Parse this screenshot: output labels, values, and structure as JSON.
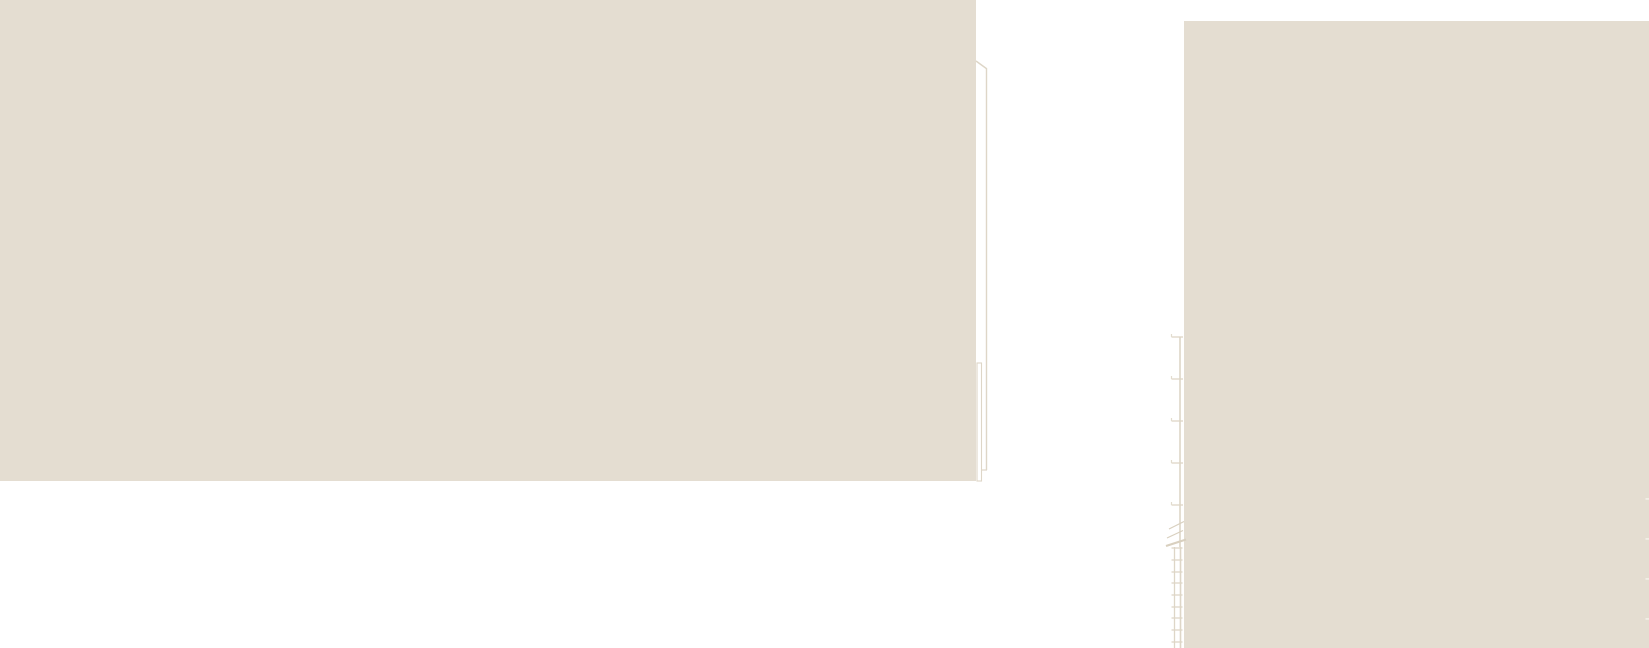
{
  "canvas": {
    "width": 1649,
    "height": 648,
    "background": "#ffffff",
    "description": "Fragment of an architectural elevation drawing: two flat wall panels, an eave edge line, a downpipe outline, and a dimension line with break symbol and ladder/scale detail"
  },
  "colors": {
    "panel_fill": "#e4ddd1",
    "hairline": "#ded6c7",
    "hairline_soft": "#e3dccf",
    "break_line": "#d9d0bf",
    "white_tick": "#f2eee6"
  },
  "panels": {
    "left_wall": {
      "x": 0,
      "y": 0,
      "w": 976,
      "h": 481
    },
    "right_wall": {
      "x": 1184,
      "y": 21,
      "w": 465,
      "h": 627
    }
  },
  "linework": {
    "eave_diagonal": {
      "x1": 976,
      "y1": 61,
      "x2": 987,
      "y2": 69
    },
    "vertical_edge": {
      "x": 986.5,
      "y1": 69,
      "y2": 470
    },
    "edge_jog": {
      "x1": 981,
      "x2": 987,
      "y": 470
    },
    "downpipe_rect": {
      "x": 977,
      "y": 363,
      "w": 4.5,
      "h": 118
    },
    "dimension_line": {
      "x": 1180,
      "y1": 337,
      "y2": 547
    },
    "dimension_ticks": {
      "x1": 1171.5,
      "x2": 1183,
      "nub_h": 3,
      "ys": [
        337,
        379,
        421,
        463,
        505
      ]
    },
    "break_diagonals": [
      {
        "x1": 1169,
        "y1": 529,
        "x2": 1184,
        "y2": 521.5,
        "w": 1.2
      },
      {
        "x1": 1167,
        "y1": 538,
        "x2": 1183,
        "y2": 530.5,
        "w": 1.2
      },
      {
        "x1": 1166,
        "y1": 546,
        "x2": 1186,
        "y2": 539.5,
        "w": 2.2
      }
    ],
    "ladder": {
      "rail1_x": 1174.5,
      "rail2_x": 1180.5,
      "y1": 547,
      "y2": 648,
      "rung_x1": 1171.5,
      "rung_x2": 1182.5,
      "rungs_y": [
        548,
        560,
        572,
        583,
        595,
        607,
        618,
        630,
        642
      ]
    },
    "edge_ticks": {
      "x": 1645.5,
      "w": 3.5,
      "h": 1.8,
      "ys": [
        498,
        538,
        578,
        618
      ]
    }
  }
}
